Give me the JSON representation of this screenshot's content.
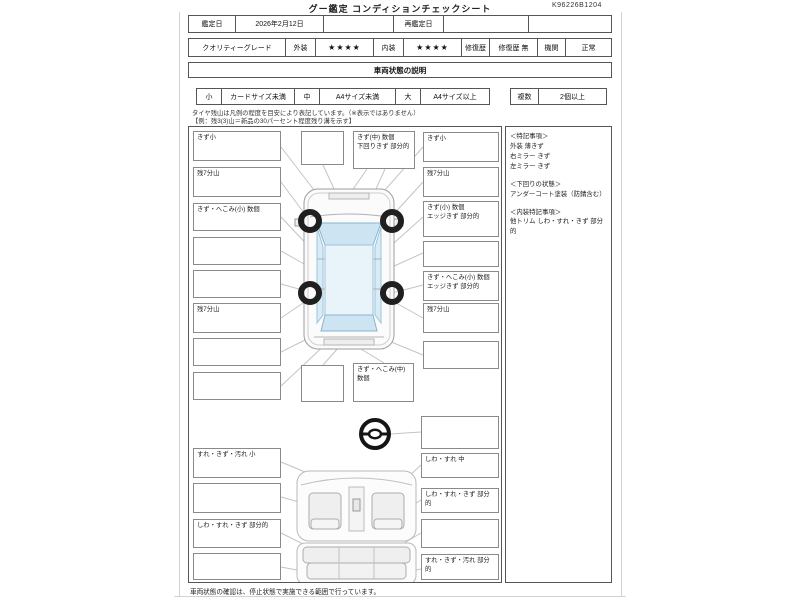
{
  "header": {
    "title": "グー鑑定 コンディションチェックシート",
    "doc_number": "K96226B1204"
  },
  "row_appraisal": {
    "date_label": "鑑定日",
    "date_value": "2026年2月12日",
    "blank1": "",
    "redate_label": "再鑑定日",
    "redate_value": "",
    "blank2": ""
  },
  "row_grade": {
    "label": "クオリティーグレード",
    "exterior_label": "外装",
    "exterior_stars": "★★★★",
    "interior_label": "内装",
    "interior_stars": "★★★★",
    "repair_label": "修復歴",
    "repair_value": "修復歴 無",
    "engine_label": "機関",
    "engine_value": "正常"
  },
  "section_title": "車両状態の説明",
  "size_legend": {
    "small_label": "小",
    "small_value": "カードサイズ未満",
    "medium_label": "中",
    "medium_value": "A4サイズ未満",
    "large_label": "大",
    "large_value": "A4サイズ以上",
    "multi_label": "複数",
    "multi_value": "2個以上"
  },
  "tire_note": {
    "line1": "タイヤ残山は凡例の程度を目安により表記しています。（※表示ではありません）",
    "line2": "【例：残3(3)山＝新品の30パーセント程度残り溝を示す】"
  },
  "exterior": {
    "left": [
      "きず小",
      "残7分山",
      "きず・へこみ(小) 数個",
      "",
      "",
      "残7分山",
      "",
      ""
    ],
    "top": [
      "",
      "きず(中) 数個\n下回りきず 部分的"
    ],
    "right": [
      "きず小",
      "残7分山",
      "きず(小) 数個\nエッジきず 部分的",
      "",
      "きず・へこみ(小) 数個\nエッジきず 部分的",
      "残7分山",
      ""
    ],
    "bottom": [
      "",
      "きず・へこみ(中) 数個"
    ],
    "steering": ""
  },
  "interior": {
    "left": [
      "すれ・きず・汚れ 小",
      "",
      "しわ・すれ・きず 部分的",
      ""
    ],
    "right": [
      "しわ・すれ 中",
      "しわ・すれ・きず 部分的",
      "",
      "すれ・きず・汚れ 部分的"
    ]
  },
  "notes": {
    "h1": "＜特記事項＞",
    "l1a": "外装 薄きず",
    "l1b": "右ミラー きず",
    "l1c": "左ミラー きず",
    "h2": "＜下回りの状態＞",
    "l2a": "アンダーコート塗装（防錆含む）",
    "h3": "＜内装特記事項＞",
    "l3a": "他トリム しわ・すれ・きず 部分的"
  },
  "footer": {
    "note": "車両状態の確認は、停止状態で実施できる範囲で行っています。"
  },
  "colors": {
    "glass": "#cde5f3",
    "roof": "#e9f4fa",
    "wheel": "#1f1f1f",
    "connector": "#c4c4c4",
    "table_border": "#555555"
  }
}
